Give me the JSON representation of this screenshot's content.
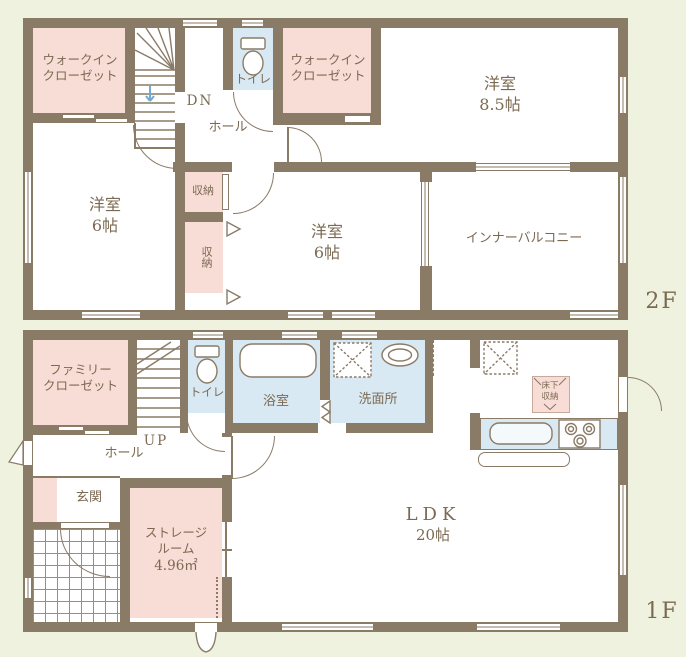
{
  "palette": {
    "background": "#eef2df",
    "wall": "#8a7b67",
    "room_pink": "#f8ddd7",
    "room_blue": "#d9e9f3",
    "floor_white": "#ffffff",
    "text": "#7b6a52",
    "stair_arrow_blue": "#74a8cf"
  },
  "floor2": {
    "floor_label": "2F",
    "wic_left": {
      "l1": "ウォークイン",
      "l2": "クローゼット"
    },
    "wic_right": {
      "l1": "ウォークイン",
      "l2": "クローゼット"
    },
    "toilet": "トイレ",
    "stairs_dn": "DN",
    "hall": "ホール",
    "room85": {
      "name": "洋室",
      "size": "8.5帖"
    },
    "room6_left": {
      "name": "洋室",
      "size": "6帖"
    },
    "room6_mid": {
      "name": "洋室",
      "size": "6帖"
    },
    "closet_upper": "収納",
    "closet_lower": "収納",
    "inner_balcony": "インナーバルコニー"
  },
  "floor1": {
    "floor_label": "1F",
    "family_closet": {
      "l1": "ファミリー",
      "l2": "クローゼット"
    },
    "stairs_up": "UP",
    "toilet": "トイレ",
    "bath": "浴室",
    "washroom": "洗面所",
    "hall": "ホール",
    "genkan": "玄関",
    "storage_room": {
      "l1": "ストレージ",
      "l2": "ルーム",
      "l3": "4.96㎡"
    },
    "ldk": {
      "name": "LDK",
      "size": "20帖"
    },
    "underfloor": {
      "l1": "床下",
      "l2": "収納"
    }
  }
}
